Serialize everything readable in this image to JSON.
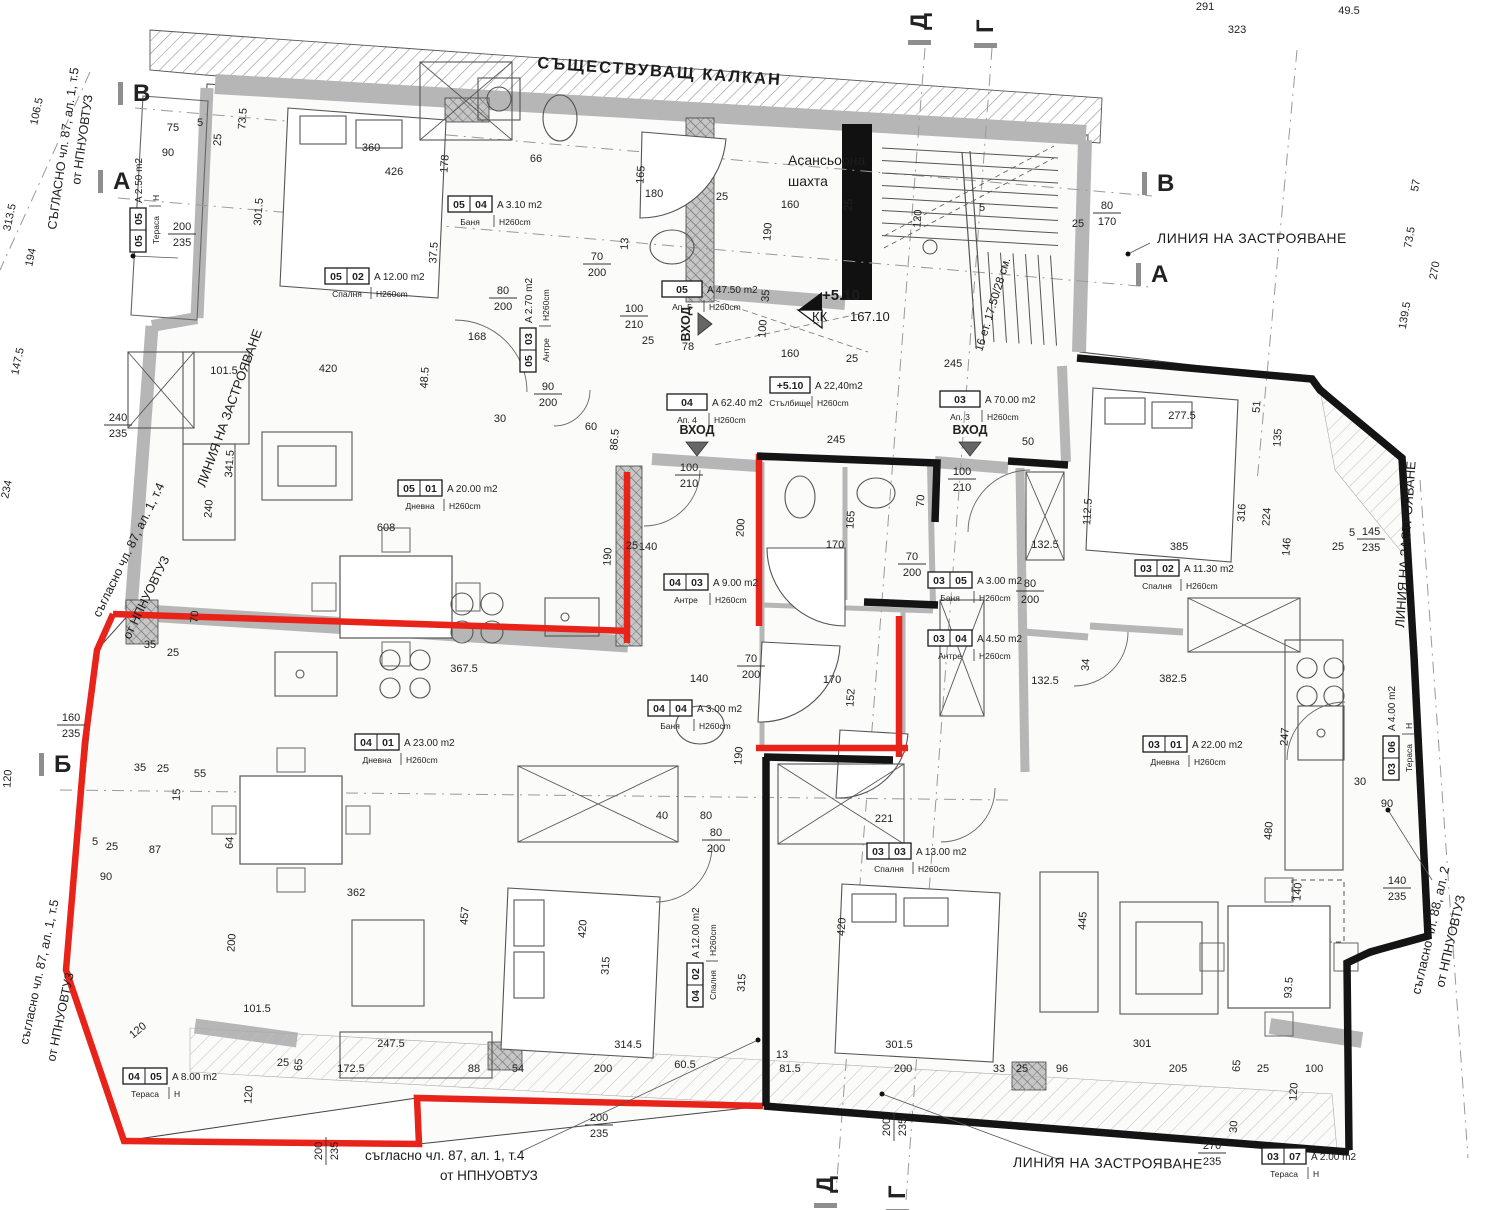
{
  "labels": {
    "kalkan": "СЪЩЕСТВУВАЩ КАЛКАН",
    "elevator1": "Асансьорна",
    "elevator2": "шахта",
    "building_line": "ЛИНИЯ НА ЗАСТРОЯВАНЕ",
    "level_mark": "+5.10",
    "kk": "КК",
    "kk_val": "167.10",
    "stair_note": "16 ет. 17.50/28 см.",
    "vhod": "ВХОД",
    "note_87_4": "съгласно чл. 87, ал. 1, т.4",
    "note_87_5": "СЪГЛАСНО чл. 87, ал. 1, т.5",
    "note_87_5b": "съгласно чл. 87, ал. 1, т.5",
    "note_88_2": "съгласно чл. 88, ал. 2",
    "note_nrm": "от НПНУОВТУЗ"
  },
  "colors": {
    "red": "#e8231a",
    "black": "#141414",
    "wall": "#b6b6b6",
    "dim": "#2b2b2b"
  },
  "room_labels": [
    {
      "x": 130,
      "y": 252,
      "r": -90,
      "n1": "05",
      "n2": "05",
      "area": "A 2.50 m2",
      "name": "Тераса",
      "h": "H"
    },
    {
      "x": 325,
      "y": 268,
      "r": 0,
      "n1": "05",
      "n2": "02",
      "area": "A 12.00 m2",
      "name": "Спалня",
      "h": "H260cm"
    },
    {
      "x": 448,
      "y": 196,
      "r": 0,
      "n1": "05",
      "n2": "04",
      "area": "A 3.10 m2",
      "name": "Баня",
      "h": "H260cm"
    },
    {
      "x": 520,
      "y": 372,
      "r": -90,
      "n1": "05",
      "n2": "03",
      "area": "A 2.70 m2",
      "name": "Антре",
      "h": "H260cm"
    },
    {
      "x": 662,
      "y": 281,
      "r": 0,
      "n1": "05",
      "n2": "",
      "area": "A 47.50 m2",
      "name": "Ап. 5",
      "h": "H260cm"
    },
    {
      "x": 398,
      "y": 480,
      "r": 0,
      "n1": "05",
      "n2": "01",
      "area": "A 20.00 m2",
      "name": "Дневна",
      "h": "H260cm"
    },
    {
      "x": 667,
      "y": 394,
      "r": 0,
      "n1": "04",
      "n2": "",
      "area": "A 62.40 m2",
      "name": "Ап. 4",
      "h": "H260cm"
    },
    {
      "x": 770,
      "y": 377,
      "r": 0,
      "n1": "+5.10",
      "n2": "",
      "area": "A 22,40m2",
      "name": "Стълбище",
      "h": "H260cm"
    },
    {
      "x": 940,
      "y": 391,
      "r": 0,
      "n1": "03",
      "n2": "",
      "area": "A 70.00 m2",
      "name": "Ап. 3",
      "h": "H260cm"
    },
    {
      "x": 664,
      "y": 574,
      "r": 0,
      "n1": "04",
      "n2": "03",
      "area": "A 9.00 m2",
      "name": "Антре",
      "h": "H260cm"
    },
    {
      "x": 928,
      "y": 572,
      "r": 0,
      "n1": "03",
      "n2": "05",
      "area": "A 3.00 m2",
      "name": "Баня",
      "h": "H260cm"
    },
    {
      "x": 928,
      "y": 630,
      "r": 0,
      "n1": "03",
      "n2": "04",
      "area": "A 4.50 m2",
      "name": "Антре",
      "h": "H260cm"
    },
    {
      "x": 1135,
      "y": 560,
      "r": 0,
      "n1": "03",
      "n2": "02",
      "area": "A 11.30 m2",
      "name": "Спалня",
      "h": "H260cm"
    },
    {
      "x": 355,
      "y": 734,
      "r": 0,
      "n1": "04",
      "n2": "01",
      "area": "A 23.00 m2",
      "name": "Дневна",
      "h": "H260cm"
    },
    {
      "x": 648,
      "y": 700,
      "r": 0,
      "n1": "04",
      "n2": "04",
      "area": "A 3.00 m2",
      "name": "Баня",
      "h": "H260cm"
    },
    {
      "x": 1143,
      "y": 736,
      "r": 0,
      "n1": "03",
      "n2": "01",
      "area": "A 22.00 m2",
      "name": "Дневна",
      "h": "H260cm"
    },
    {
      "x": 1383,
      "y": 780,
      "r": -90,
      "n1": "03",
      "n2": "06",
      "area": "A 4.00 m2",
      "name": "Тераса",
      "h": "H"
    },
    {
      "x": 687,
      "y": 1007,
      "r": -90,
      "n1": "04",
      "n2": "02",
      "area": "A 12.00 m2",
      "name": "Спалня",
      "h": "H260cm"
    },
    {
      "x": 867,
      "y": 843,
      "r": 0,
      "n1": "03",
      "n2": "03",
      "area": "A 13.00 m2",
      "name": "Спалня",
      "h": "H260cm"
    },
    {
      "x": 123,
      "y": 1068,
      "r": 0,
      "n1": "04",
      "n2": "05",
      "area": "A 8.00 m2",
      "name": "Тераса",
      "h": "H"
    },
    {
      "x": 1262,
      "y": 1148,
      "r": 0,
      "n1": "03",
      "n2": "07",
      "area": "A 2.00 m2",
      "name": "Тераса",
      "h": "H"
    }
  ],
  "markers": [
    [
      133,
      101,
      0,
      "В"
    ],
    [
      113,
      189,
      0,
      "А"
    ],
    [
      54,
      772,
      0,
      "Б"
    ],
    [
      1157,
      191,
      0,
      "В"
    ],
    [
      1151,
      282,
      0,
      "А"
    ],
    [
      927,
      30,
      -90,
      "Д"
    ],
    [
      993,
      33,
      -90,
      "Г"
    ],
    [
      833,
      1193,
      -90,
      "Д"
    ],
    [
      905,
      1199,
      -90,
      "Г"
    ]
  ],
  "entrances": [
    {
      "x": 697,
      "y": 434,
      "r": 0
    },
    {
      "x": 970,
      "y": 434,
      "r": 0
    },
    {
      "x": 690,
      "y": 324,
      "r": -90
    }
  ],
  "dims": [
    [
      1205,
      10,
      0,
      "291"
    ],
    [
      1349,
      14,
      0,
      "49.5"
    ],
    [
      1237,
      33,
      0,
      "323"
    ],
    [
      1419,
      186,
      -80,
      "57"
    ],
    [
      1413,
      238,
      -80,
      "73.5"
    ],
    [
      1438,
      271,
      -80,
      "270"
    ],
    [
      1408,
      316,
      -80,
      "139.5"
    ],
    [
      40,
      112,
      -78,
      "106.5"
    ],
    [
      13,
      218,
      -78,
      "313.5"
    ],
    [
      34,
      258,
      -78,
      "194"
    ],
    [
      21,
      362,
      -78,
      "147.5"
    ],
    [
      10,
      490,
      -78,
      "234"
    ],
    [
      11,
      779,
      -86,
      "120"
    ],
    [
      173,
      131,
      0,
      "75"
    ],
    [
      200,
      126,
      0,
      "5"
    ],
    [
      168,
      156,
      0,
      "90"
    ],
    [
      221,
      140,
      -86,
      "25"
    ],
    [
      246,
      119,
      -86,
      "73.5"
    ],
    [
      262,
      212,
      -86,
      "301.5"
    ],
    [
      371,
      151,
      0,
      "360"
    ],
    [
      394,
      175,
      0,
      "426"
    ],
    [
      448,
      164,
      -86,
      "178"
    ],
    [
      437,
      253,
      -86,
      "37.5"
    ],
    [
      536,
      162,
      0,
      "66"
    ],
    [
      654,
      197,
      0,
      "180"
    ],
    [
      644,
      175,
      -86,
      "165"
    ],
    [
      722,
      200,
      0,
      "25"
    ],
    [
      628,
      244,
      -86,
      "13"
    ],
    [
      790,
      208,
      0,
      "160"
    ],
    [
      771,
      232,
      -86,
      "190"
    ],
    [
      852,
      205,
      -86,
      "25"
    ],
    [
      921,
      219,
      -86,
      "120"
    ],
    [
      982,
      211,
      0,
      "5"
    ],
    [
      1078,
      227,
      0,
      "25"
    ],
    [
      769,
      296,
      -86,
      "35"
    ],
    [
      766,
      329,
      -86,
      "100"
    ],
    [
      790,
      357,
      0,
      "160"
    ],
    [
      852,
      362,
      0,
      "25"
    ],
    [
      953,
      367,
      0,
      "245"
    ],
    [
      836,
      443,
      0,
      "245"
    ],
    [
      1028,
      445,
      0,
      "50"
    ],
    [
      477,
      340,
      0,
      "168"
    ],
    [
      648,
      344,
      0,
      "25"
    ],
    [
      688,
      350,
      0,
      "78"
    ],
    [
      328,
      372,
      0,
      "420"
    ],
    [
      233,
      464,
      -86,
      "341.5"
    ],
    [
      212,
      509,
      -86,
      "240"
    ],
    [
      386,
      531,
      0,
      "608"
    ],
    [
      428,
      378,
      -86,
      "48.5"
    ],
    [
      500,
      422,
      0,
      "30"
    ],
    [
      591,
      430,
      0,
      "60"
    ],
    [
      618,
      440,
      -86,
      "86.5"
    ],
    [
      611,
      557,
      -86,
      "190"
    ],
    [
      632,
      549,
      0,
      "25"
    ],
    [
      224,
      374,
      0,
      "101.5"
    ],
    [
      464,
      672,
      0,
      "367.5"
    ],
    [
      150,
      648,
      0,
      "35"
    ],
    [
      173,
      656,
      0,
      "25"
    ],
    [
      198,
      617,
      -86,
      "70"
    ],
    [
      648,
      550,
      0,
      "140"
    ],
    [
      744,
      528,
      -86,
      "200"
    ],
    [
      835,
      548,
      0,
      "170"
    ],
    [
      1045,
      548,
      0,
      "132.5"
    ],
    [
      854,
      520,
      -86,
      "165"
    ],
    [
      924,
      501,
      -86,
      "70"
    ],
    [
      699,
      682,
      0,
      "140"
    ],
    [
      832,
      683,
      0,
      "170"
    ],
    [
      854,
      698,
      -86,
      "152"
    ],
    [
      742,
      756,
      -86,
      "190"
    ],
    [
      1045,
      684,
      0,
      "132.5"
    ],
    [
      140,
      771,
      0,
      "35"
    ],
    [
      163,
      772,
      0,
      "25"
    ],
    [
      200,
      777,
      0,
      "55"
    ],
    [
      180,
      795,
      -86,
      "15"
    ],
    [
      155,
      853,
      0,
      "87"
    ],
    [
      112,
      850,
      0,
      "25"
    ],
    [
      95,
      845,
      0,
      "5"
    ],
    [
      106,
      880,
      0,
      "90"
    ],
    [
      356,
      896,
      0,
      "362"
    ],
    [
      233,
      843,
      -86,
      "64"
    ],
    [
      235,
      943,
      -86,
      "200"
    ],
    [
      468,
      916,
      -86,
      "457"
    ],
    [
      586,
      929,
      -86,
      "420"
    ],
    [
      609,
      966,
      -86,
      "315"
    ],
    [
      845,
      927,
      -86,
      "420"
    ],
    [
      745,
      983,
      -86,
      "315"
    ],
    [
      884,
      822,
      0,
      "221"
    ],
    [
      662,
      819,
      0,
      "40"
    ],
    [
      706,
      819,
      0,
      "80"
    ],
    [
      628,
      1048,
      0,
      "314.5"
    ],
    [
      899,
      1048,
      0,
      "301.5"
    ],
    [
      782,
      1058,
      0,
      "13"
    ],
    [
      474,
      1072,
      0,
      "88"
    ],
    [
      518,
      1072,
      0,
      "54"
    ],
    [
      603,
      1072,
      0,
      "200"
    ],
    [
      685,
      1068,
      0,
      "60.5"
    ],
    [
      790,
      1072,
      0,
      "81.5"
    ],
    [
      351,
      1072,
      0,
      "172.5"
    ],
    [
      302,
      1065,
      -86,
      "65"
    ],
    [
      283,
      1066,
      0,
      "25"
    ],
    [
      391,
      1047,
      0,
      "247.5"
    ],
    [
      257,
      1012,
      0,
      "101.5"
    ],
    [
      140,
      1033,
      -40,
      "120"
    ],
    [
      252,
      1095,
      -86,
      "120"
    ],
    [
      903,
      1072,
      0,
      "200"
    ],
    [
      1173,
      682,
      0,
      "382.5"
    ],
    [
      1288,
      737,
      -86,
      "247"
    ],
    [
      1272,
      831,
      -86,
      "480"
    ],
    [
      1301,
      892,
      -86,
      "140"
    ],
    [
      1360,
      785,
      0,
      "30"
    ],
    [
      1387,
      807,
      0,
      "90"
    ],
    [
      1089,
      665,
      -86,
      "34"
    ],
    [
      1086,
      921,
      -86,
      "445"
    ],
    [
      1292,
      988,
      -86,
      "93.5"
    ],
    [
      1142,
      1047,
      0,
      "301"
    ],
    [
      1062,
      1072,
      0,
      "96"
    ],
    [
      999,
      1072,
      0,
      "33"
    ],
    [
      1022,
      1072,
      0,
      "25"
    ],
    [
      1178,
      1072,
      0,
      "205"
    ],
    [
      1240,
      1066,
      -86,
      "65"
    ],
    [
      1263,
      1072,
      0,
      "25"
    ],
    [
      1314,
      1072,
      0,
      "100"
    ],
    [
      1297,
      1092,
      -86,
      "120"
    ],
    [
      1237,
      1127,
      -86,
      "30"
    ],
    [
      1182,
      419,
      0,
      "277.5"
    ],
    [
      1091,
      512,
      -86,
      "112.5"
    ],
    [
      1179,
      550,
      0,
      "385"
    ],
    [
      1245,
      513,
      -86,
      "316"
    ],
    [
      1270,
      517,
      -86,
      "224"
    ],
    [
      1290,
      547,
      -86,
      "146"
    ],
    [
      1281,
      438,
      -86,
      "135"
    ],
    [
      1260,
      407,
      -86,
      "51"
    ],
    [
      1338,
      550,
      0,
      "25"
    ],
    [
      1352,
      536,
      0,
      "5"
    ]
  ],
  "stacked_dims": [
    [
      182,
      233,
      0,
      "200",
      "235"
    ],
    [
      118,
      424,
      0,
      "240",
      "235"
    ],
    [
      71,
      724,
      0,
      "160",
      "235"
    ],
    [
      503,
      297,
      0,
      "80",
      "200"
    ],
    [
      597,
      263,
      0,
      "70",
      "200"
    ],
    [
      634,
      315,
      0,
      "100",
      "210"
    ],
    [
      548,
      393,
      0,
      "90",
      "200"
    ],
    [
      689,
      474,
      0,
      "100",
      "210"
    ],
    [
      962,
      478,
      0,
      "100",
      "210"
    ],
    [
      912,
      563,
      0,
      "70",
      "200"
    ],
    [
      1030,
      590,
      0,
      "80",
      "200"
    ],
    [
      751,
      665,
      0,
      "70",
      "200"
    ],
    [
      716,
      839,
      0,
      "80",
      "200"
    ],
    [
      1107,
      212,
      0,
      "80",
      "170"
    ],
    [
      325,
      1151,
      -90,
      "200",
      "235"
    ],
    [
      599,
      1124,
      0,
      "200",
      "235"
    ],
    [
      893,
      1127,
      -90,
      "200",
      "235"
    ],
    [
      1212,
      1152,
      0,
      "270",
      "235"
    ],
    [
      1397,
      887,
      0,
      "140",
      "235"
    ],
    [
      1371,
      538,
      0,
      "145",
      "235"
    ]
  ]
}
